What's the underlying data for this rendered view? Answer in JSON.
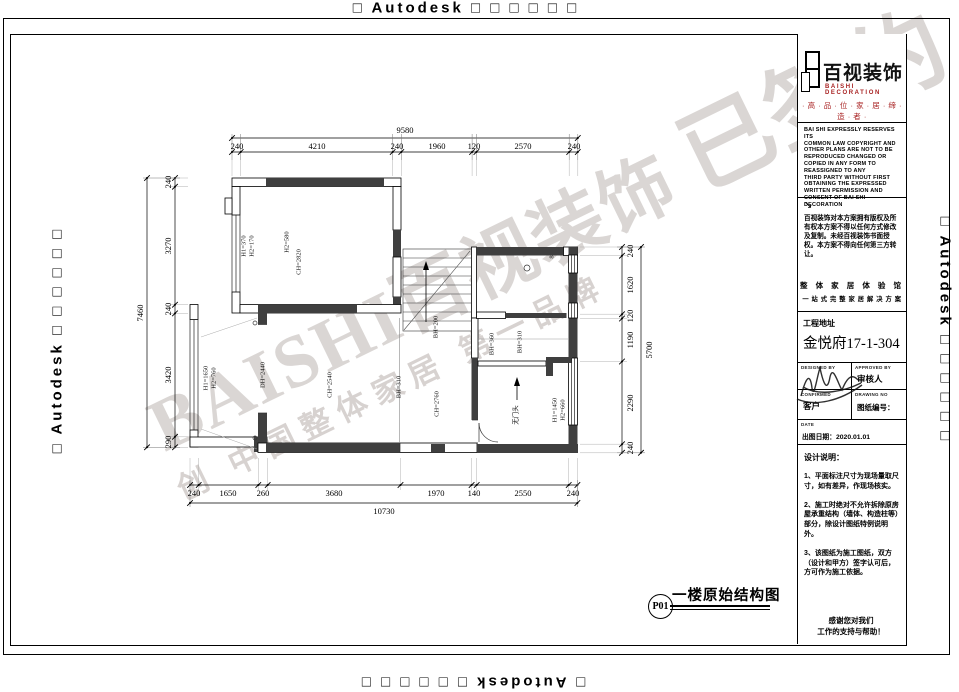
{
  "stamps": {
    "text": "□ Autodesk □ □ □ □ □ □"
  },
  "watermark": {
    "line1_a": "BAISHI百视装饰 ",
    "line1_b": "已签约",
    "line2": "创 中国整体家居 第一品牌"
  },
  "title_block": {
    "logo": {
      "cn": "百视装饰",
      "en": "BAISHI DECORATION",
      "tagline": "· 高 · 品 · 位 · 家 · 居 · 缔 · 造 · 者 ·"
    },
    "copyright_en": [
      "BAI SHI EXPRESSLY RESERVES ITS",
      "COMMON LAW COPYRIGHT AND",
      "OTHER PLANS ARE NOT TO BE",
      "REPRODUCED CHANGED OR",
      "COPIED IN ANY FORM TO",
      "REASSIGNED TO ANY",
      "THIRD PARTY WITHOUT FIRST",
      "OBTAINING THE EXPRESSED",
      "WRITTEN PERMISSION AND",
      "CONSENT OF BAI SHI",
      "DECORATION"
    ],
    "arrow": "↘",
    "copyright_cn": "百视装饰对本方案拥有版权及所有权本方案不得以任何方式修改及复制。未经百视装饰书面授权。本方案不得向任何第三方转让。",
    "slogan1": "整 体 家 居 体 验 馆",
    "slogan2": "一 站 式 完 整 家 居 解 决 方 案",
    "address_label": "工程地址",
    "address_value": "金悦府17-1-304",
    "cells": {
      "designed_by": "DESIGNED BY",
      "approved_by": "APPROVED BY",
      "approver": "审核人",
      "confirmed": "CONFIRMED",
      "customer": "客户",
      "drawing_no_label": "DRAWING NO",
      "drawing_no_cn": "图纸编号：",
      "date_label": "DATE",
      "date_value": "出图日期：2020.01.01"
    },
    "notes_title": "设计说明：",
    "notes": [
      "1、平面标注尺寸为现场量取尺寸，如有差异，作现场核实。",
      "2、施工时绝对不允许拆除原房屋承重结构（墙体、构造柱等）部分，除设计图纸特例说明外。",
      "3、该图纸为施工图纸，双方（设计和甲方）签字认可后，方可作为施工依据。"
    ],
    "thanks": "感谢您对我们\n工作的支持与帮助！"
  },
  "plan": {
    "sheet_title": "一楼原始结构图",
    "sheet_no": "P01",
    "dim_labels": [
      {
        "t": "9580",
        "x": 405,
        "y": 130,
        "r": 0
      },
      {
        "t": "240",
        "x": 237,
        "y": 146,
        "r": 0
      },
      {
        "t": "4210",
        "x": 317,
        "y": 146,
        "r": 0
      },
      {
        "t": "240",
        "x": 397,
        "y": 146,
        "r": 0
      },
      {
        "t": "1960",
        "x": 437,
        "y": 146,
        "r": 0
      },
      {
        "t": "120",
        "x": 474,
        "y": 146,
        "r": 0
      },
      {
        "t": "2570",
        "x": 523,
        "y": 146,
        "r": 0
      },
      {
        "t": "240",
        "x": 574,
        "y": 146,
        "r": 0
      },
      {
        "t": "240",
        "x": 194,
        "y": 493,
        "r": 0
      },
      {
        "t": "1650",
        "x": 228,
        "y": 493,
        "r": 0
      },
      {
        "t": "260",
        "x": 263,
        "y": 493,
        "r": 0
      },
      {
        "t": "3680",
        "x": 334,
        "y": 493,
        "r": 0
      },
      {
        "t": "1970",
        "x": 436,
        "y": 493,
        "r": 0
      },
      {
        "t": "140",
        "x": 474,
        "y": 493,
        "r": 0
      },
      {
        "t": "2550",
        "x": 523,
        "y": 493,
        "r": 0
      },
      {
        "t": "240",
        "x": 573,
        "y": 493,
        "r": 0
      },
      {
        "t": "10730",
        "x": 384,
        "y": 511,
        "r": 0
      },
      {
        "t": "7460",
        "x": 140,
        "y": 313,
        "r": -90
      },
      {
        "t": "240",
        "x": 168,
        "y": 182,
        "r": -90
      },
      {
        "t": "3270",
        "x": 168,
        "y": 246,
        "r": -90
      },
      {
        "t": "240",
        "x": 168,
        "y": 309,
        "r": -90
      },
      {
        "t": "3420",
        "x": 168,
        "y": 375,
        "r": -90
      },
      {
        "t": "290",
        "x": 168,
        "y": 442,
        "r": -90
      },
      {
        "t": "5700",
        "x": 649,
        "y": 350,
        "r": -90
      },
      {
        "t": "240",
        "x": 630,
        "y": 251,
        "r": -90
      },
      {
        "t": "1620",
        "x": 630,
        "y": 285,
        "r": -90
      },
      {
        "t": "120",
        "x": 630,
        "y": 316,
        "r": -90
      },
      {
        "t": "1190",
        "x": 630,
        "y": 340,
        "r": -90
      },
      {
        "t": "2290",
        "x": 630,
        "y": 403,
        "r": -90
      },
      {
        "t": "240",
        "x": 630,
        "y": 448,
        "r": -90
      }
    ],
    "room_labels": [
      {
        "t": "H1=370\nH2=170",
        "x": 248,
        "y": 246
      },
      {
        "t": "H2=580",
        "x": 287,
        "y": 242
      },
      {
        "t": "CH=2820",
        "x": 299,
        "y": 262
      },
      {
        "t": "H1=1650\nH2=760",
        "x": 210,
        "y": 378
      },
      {
        "t": "DH=2440",
        "x": 263,
        "y": 375
      },
      {
        "t": "CH=2540",
        "x": 330,
        "y": 385
      },
      {
        "t": "BH=310",
        "x": 399,
        "y": 387
      },
      {
        "t": "BH=200",
        "x": 436,
        "y": 327
      },
      {
        "t": "CH=2760",
        "x": 437,
        "y": 404
      },
      {
        "t": "BH=360",
        "x": 492,
        "y": 344
      },
      {
        "t": "BH=310",
        "x": 520,
        "y": 342
      },
      {
        "t": "无门头",
        "x": 516,
        "y": 415
      },
      {
        "t": "H1=1450\nH2=660",
        "x": 559,
        "y": 410
      },
      {
        "t": "8",
        "x": 552,
        "y": 257
      }
    ]
  }
}
